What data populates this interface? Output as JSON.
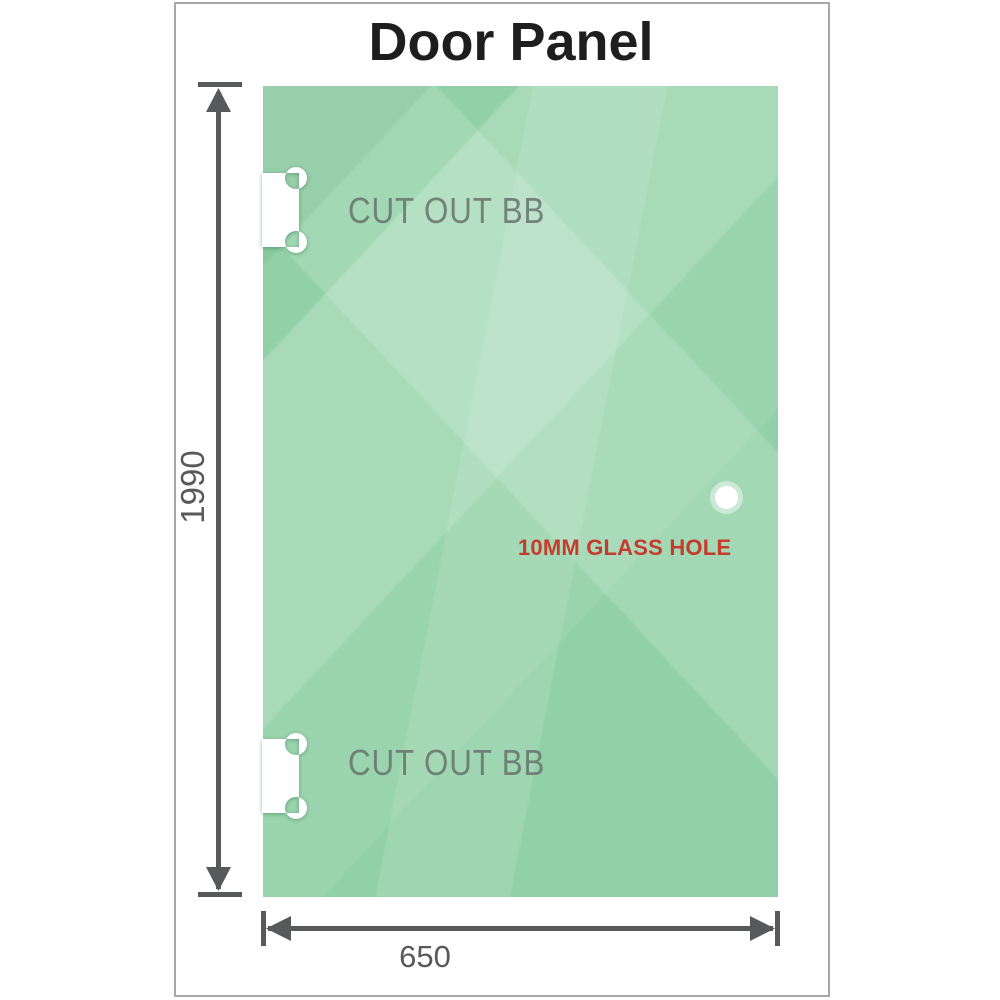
{
  "title": "Door Panel",
  "glass_panel": {
    "cutouts": [
      {
        "label": "CUT OUT BB"
      },
      {
        "label": "CUT OUT BB"
      }
    ],
    "hole": {
      "label": "10MM GLASS HOLE"
    }
  },
  "dimensions": {
    "height": "1990",
    "width": "650"
  },
  "colors": {
    "glass_base": "#92d1a7",
    "dimension_gray": "#58595b",
    "hole_label_red": "#c53b2d",
    "cutout_label_gray": "#68736d",
    "frame_border": "#a8a8a8",
    "title_black": "#1e1e1e",
    "cutout_white": "#ffffff"
  }
}
